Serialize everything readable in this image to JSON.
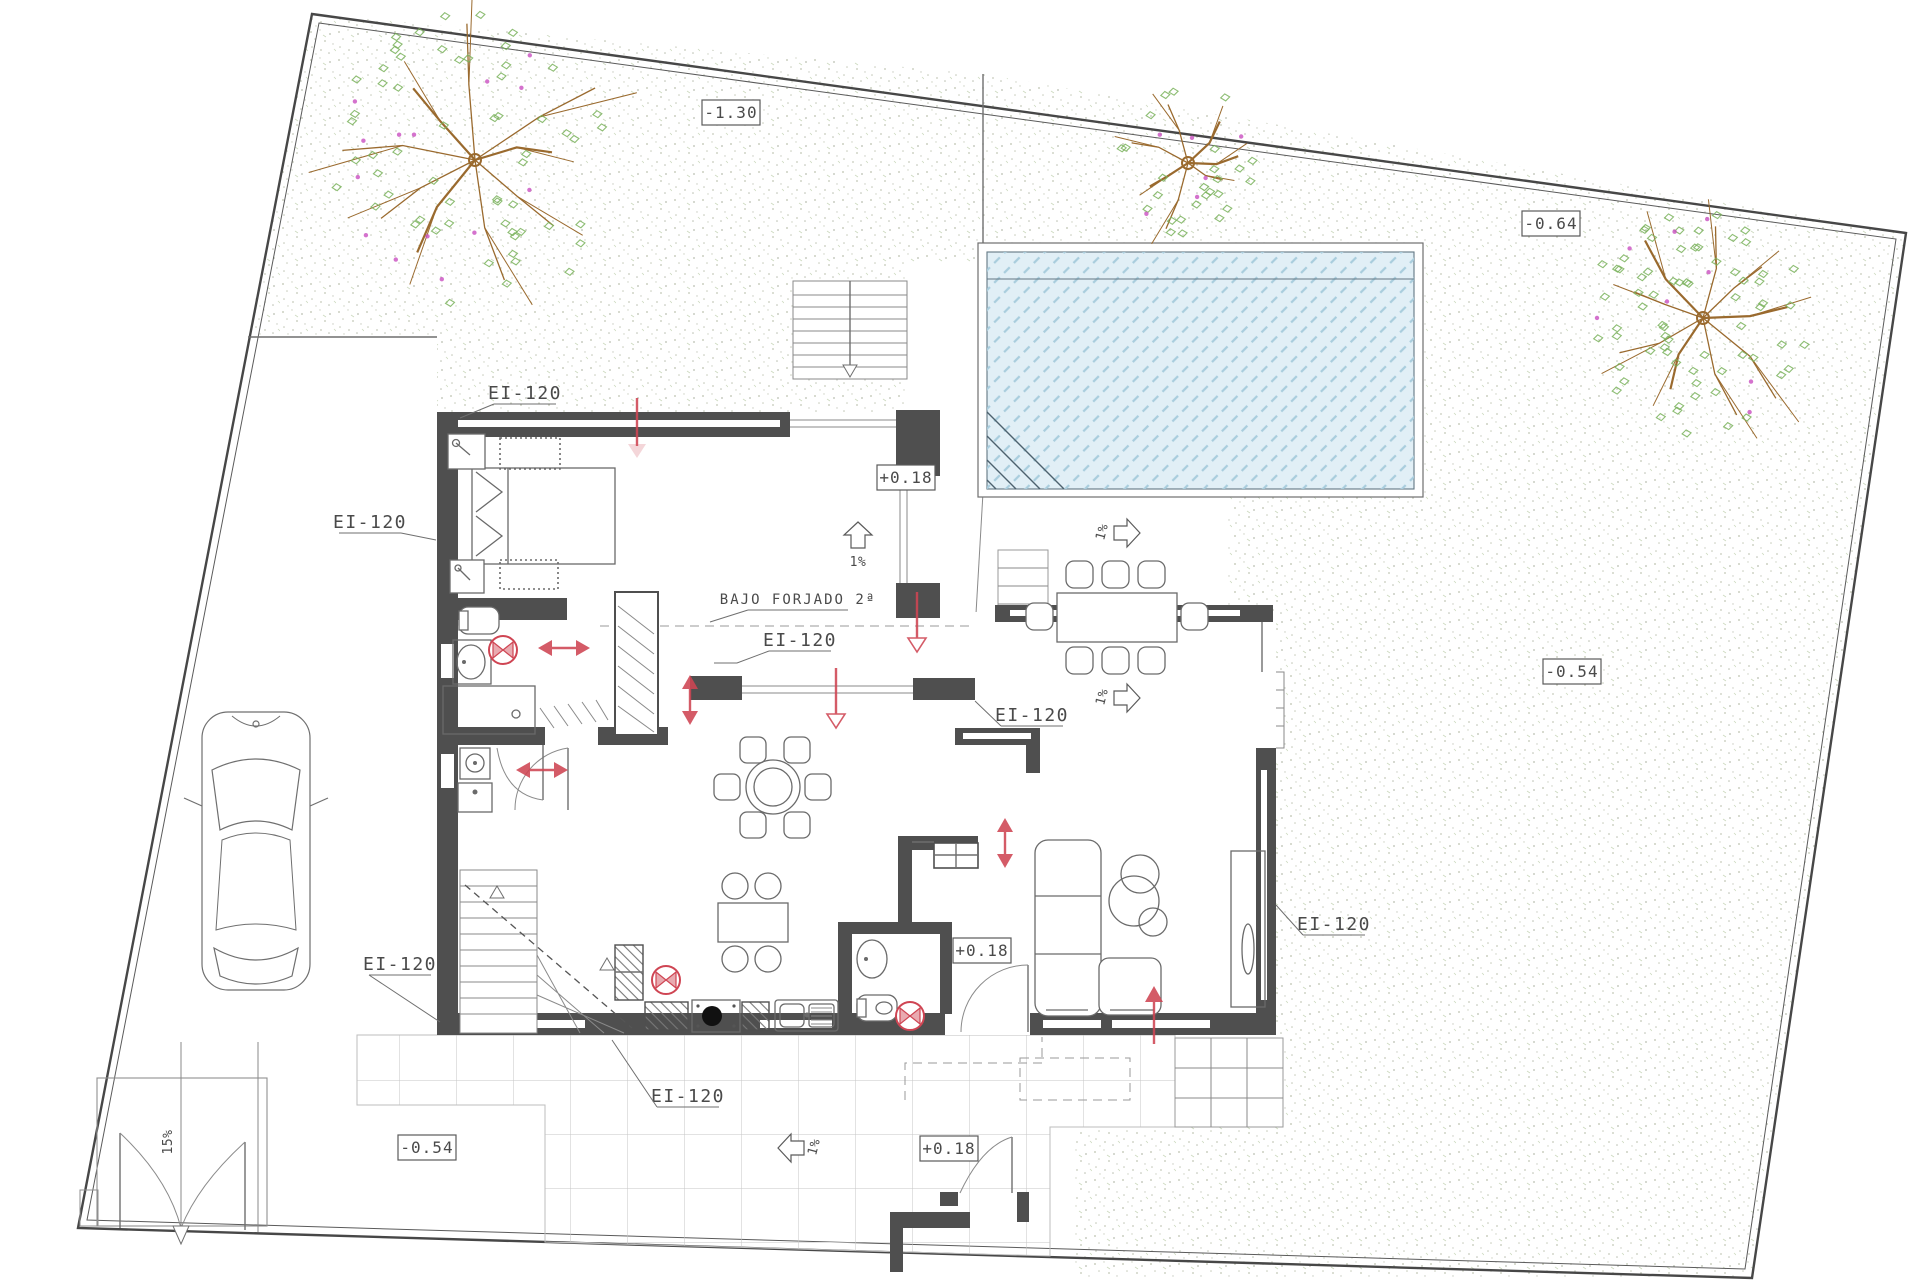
{
  "drawing": {
    "type": "architectural ground-floor site plan",
    "labels": {
      "fire_rating": "EI-120",
      "note_under_slab": "BAJO FORJADO 2ª",
      "level_garden_nw": "-1.30",
      "level_garden_ne": "-0.64",
      "level_garden_e": "-0.54",
      "level_terrace_sw": "-0.54",
      "level_main_floor": "+0.18",
      "level_entry_east": "+0.18",
      "level_terrace_south": "+0.18",
      "slope_one_percent": "1%",
      "slope_ramp": "15%"
    },
    "colors": {
      "annotation_red": "#cf4553",
      "pool_water": "#e1eff6",
      "pool_hatch": "#a9cddd",
      "wall": "#4f4f4f",
      "foliage_green": "#79b25b",
      "branch_brown": "#9a6a2e",
      "flower_magenta": "#c94fc0",
      "garden_stipple": "#97a083"
    }
  }
}
